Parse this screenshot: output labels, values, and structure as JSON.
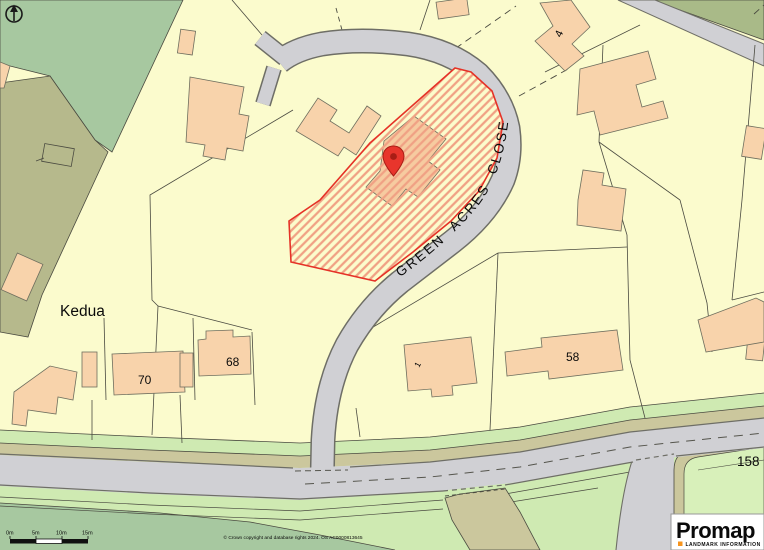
{
  "map": {
    "street_label": "GREEN ACRES CLOSE",
    "labels": {
      "property_name": "Kedua",
      "house_4": "4",
      "house_70": "70",
      "house_68": "68",
      "house_58": "58",
      "house_1": "1",
      "house_158": "158"
    },
    "marker_color": "#e8352c",
    "plot_outline_color": "#e53227",
    "hatch_color": "#f0a184",
    "road_color": "#d0d0d4",
    "parcel_color": "#fbfbcd",
    "green_color": "#a7c8a0",
    "olive_color": "#b6b98c",
    "verge_color": "#cfeab2"
  },
  "scale_bar": {
    "ticks": [
      "0m",
      "5m",
      "10m",
      "15m"
    ]
  },
  "attribution": "© Crown copyright and database rights 2024. OS AC0000813645",
  "logo": {
    "brand": "Promap",
    "tagline": "LANDMARK INFORMATION",
    "accent_color": "#f7941d"
  }
}
